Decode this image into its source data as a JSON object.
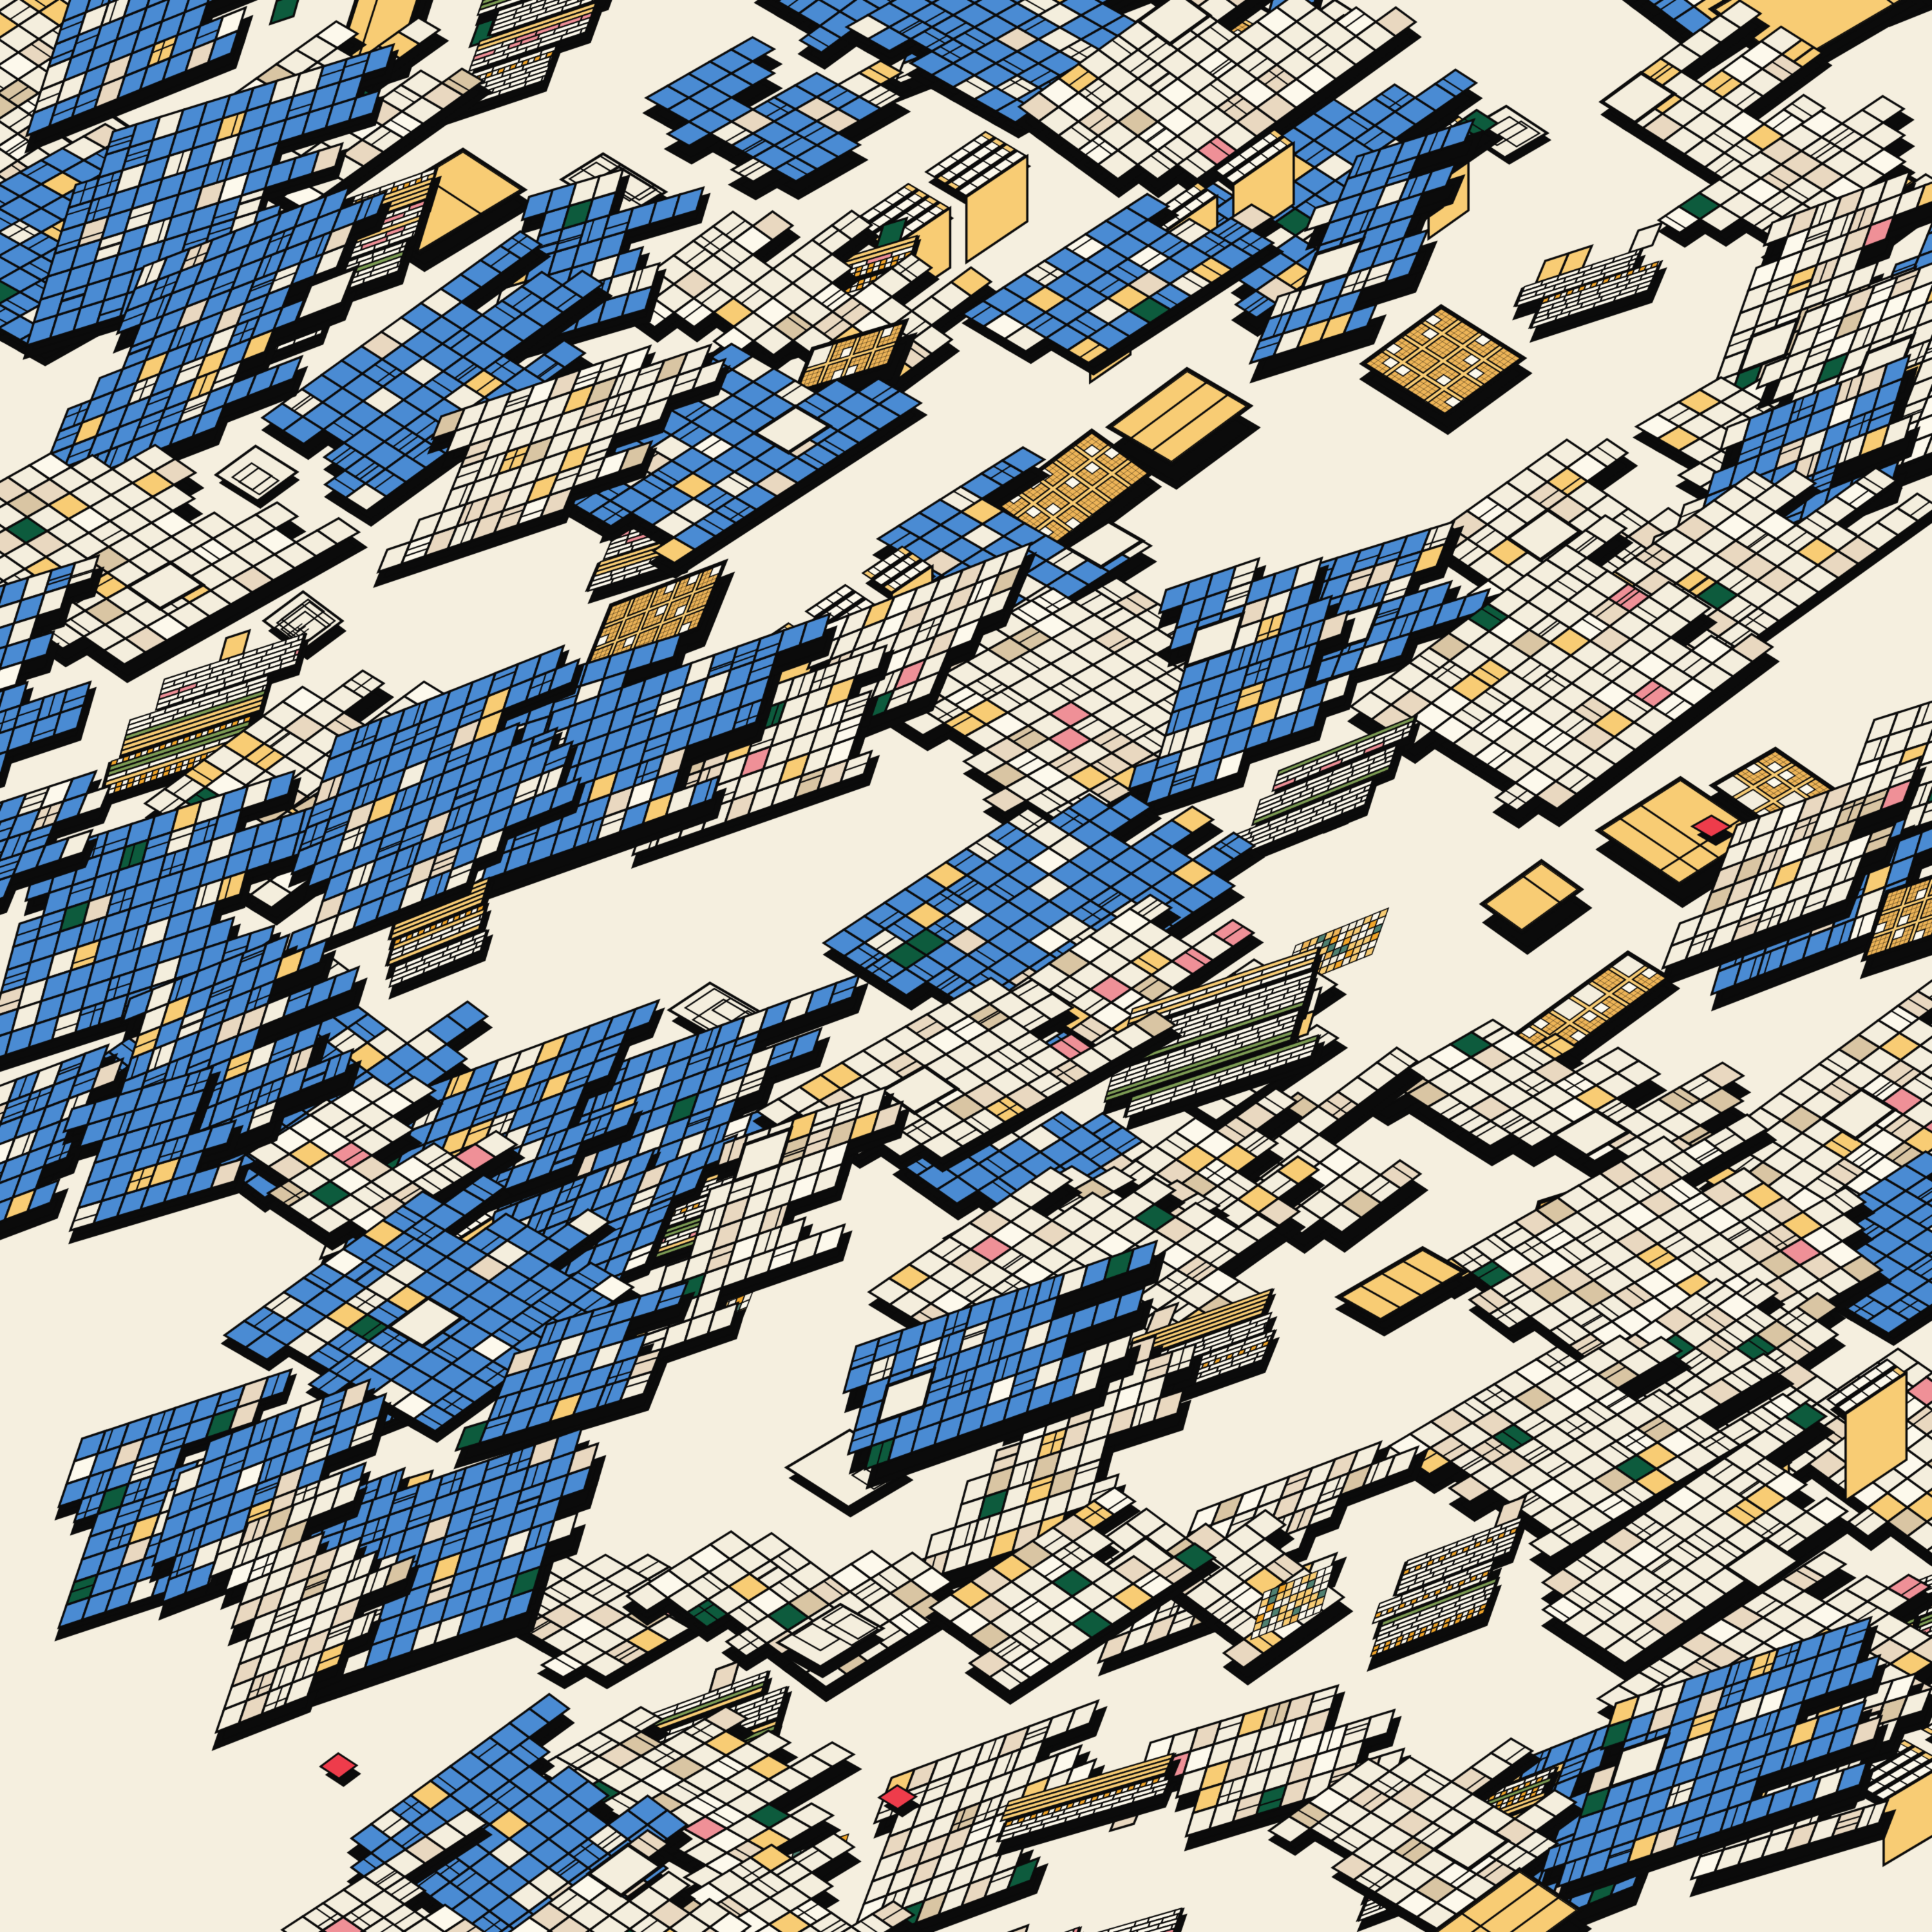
{
  "artwork": {
    "description": "isometric-generative-patchwork",
    "seed": 911772437,
    "palette": {
      "background": "#f5efdf",
      "cream": "#f4eedd",
      "cream_bright": "#fdf9ec",
      "beige": "#e9d8c0",
      "tan": "#d9c5a3",
      "blue": "#4a8bd3",
      "gold": "#f8cc74",
      "gold_deep": "#eeb558",
      "orange": "#f2a62a",
      "olive": "#7d9c54",
      "dark_green": "#0d5b3d",
      "teal": "#4f8070",
      "pink": "#ef9097",
      "red": "#ee3c4b",
      "black": "#0b0b0b"
    },
    "geometry": {
      "canvas_size": 3000,
      "cell": 38,
      "diamond_angle": 33,
      "lean_shallow": 19,
      "lean_steep": 71,
      "line": 3.4,
      "thin": 2.2,
      "border": 5.5
    },
    "lattice": {
      "step_a": [
        212,
        -84
      ],
      "step_b": [
        96,
        242
      ],
      "jitter": 62,
      "range_a": [
        -3,
        18
      ],
      "range_b": [
        -3,
        20
      ]
    },
    "zones": {
      "amp": 0.75,
      "f1": 0.00085,
      "f2": 0.0011
    },
    "motif_weights": {
      "blue_field": 30,
      "cream_field": 26,
      "stripe_cluster": 22,
      "gold_plaza": 11,
      "wireframe": 5,
      "towers": 4,
      "checker": 3
    },
    "red_accents": {
      "count": 3,
      "size": 0.9
    }
  }
}
